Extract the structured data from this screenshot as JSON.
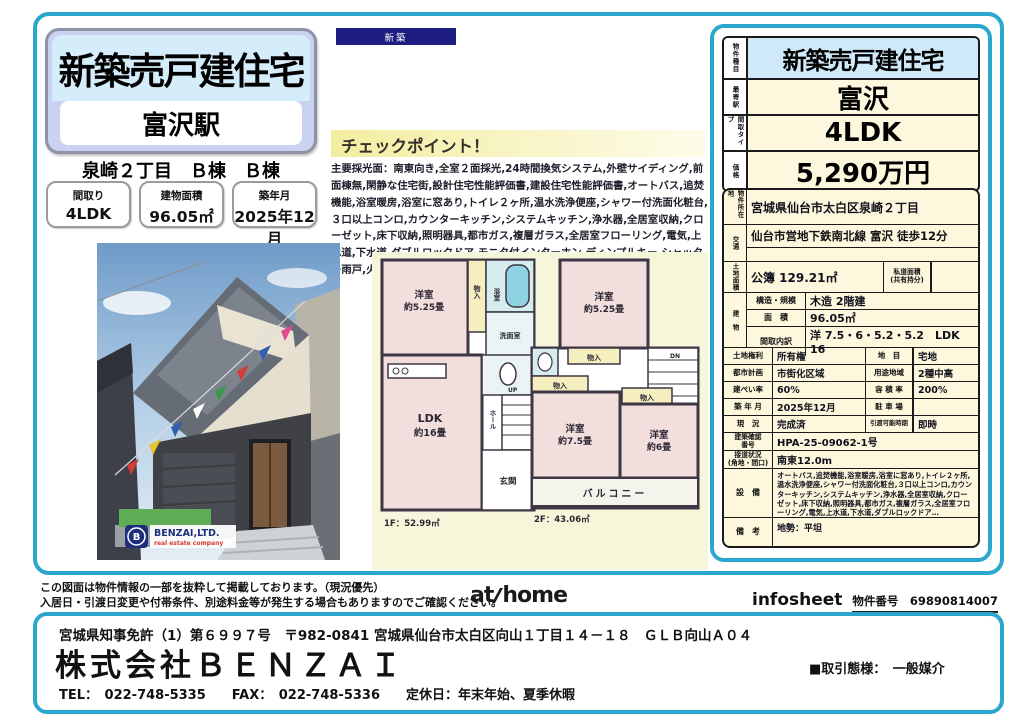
{
  "accent": {
    "cyan": "#2aa7cd",
    "navy": "#1d1d82",
    "cream": "#fdf8dd",
    "light_blue": "#cfe9f8"
  },
  "badge": {
    "label": "新築"
  },
  "title_card": {
    "title": "新築売戸建住宅",
    "station": "富沢駅",
    "location": "泉崎２丁目　Ｂ棟　Ｂ棟",
    "specs": [
      {
        "label": "間取り",
        "value": "4LDK"
      },
      {
        "label": "建物面積",
        "value": "96.05㎡"
      },
      {
        "label": "築年月",
        "value": "2025年12月"
      }
    ]
  },
  "checkpoint": {
    "heading": "チェックポイント！",
    "body": "主要採光面：南東向き,全室２面採光,24時間換気システム,外壁サイディング,前面棟無,閑静な住宅街,設計住宅性能評価書,建設住宅性能評価書,オートバス,追焚機能,浴室暖房,浴室に窓あり,トイレ２ヶ所,温水洗浄便座,シャワー付洗面化粧台,３口以上コンロ,カウンターキッチン,システムキッチン,浄水器,全居室収納,クローゼット,床下収納,照明器具,都市ガス,複層ガラス,全居室フローリング,電気,上水道,下水道,ダブルロックドア,モニタ付インターホン,ディンプルキー,シャッター雨戸,火災警報器（報知機）,ワイドバルコニー,駐車場２台分"
  },
  "photo": {
    "logo_initial": "B",
    "logo_name": "BENZAI,LTD.",
    "logo_sub": "real estate company"
  },
  "floorplan": {
    "f1": {
      "bedroom": "洋室",
      "bedroom_size": "約5.25畳",
      "closet": "物入",
      "bath": "浴室",
      "washroom": "洗面室",
      "ldk": "LDK",
      "ldk_size": "約16畳",
      "hall": "ホール",
      "up": "UP",
      "entrance": "玄関",
      "area": "1F：52.99㎡"
    },
    "f2": {
      "bedroom": "洋室",
      "bedroom_size": "約5.25畳",
      "closet1": "物入",
      "closet2": "物入",
      "closet3": "物入",
      "bedroom2": "洋室",
      "bedroom2_size": "約7.5畳",
      "bedroom3": "洋室",
      "bedroom3_size": "約6畳",
      "balcony": "バルコニー",
      "dn": "DN",
      "area": "2F：43.06㎡"
    }
  },
  "summary": {
    "rows": [
      {
        "label": "物件種目",
        "value": "新築売戸建住宅"
      },
      {
        "label": "最寄駅",
        "value": "富沢"
      },
      {
        "label": "間取タイプ",
        "value": "4LDK"
      },
      {
        "label": "価格",
        "value": "5,290万円"
      }
    ]
  },
  "detail": {
    "location_label": "物件所在地",
    "location": "宮城県仙台市太白区泉崎２丁目",
    "access_label": "交通",
    "access": "仙台市営地下鉄南北線 富沢 徒歩12分",
    "land_label": "土地面積",
    "land": "公簿 129.21㎡",
    "private_road_label1": "私道面積",
    "private_road_label2": "(共有持分)",
    "private_road": "",
    "building_label": "建　物",
    "structure_label": "構造・規模",
    "structure": "木造 2階建",
    "barea_label": "面　積",
    "barea": "96.05㎡",
    "layout_label": "間取内訳",
    "layout": "洋 7.5・6・5.2・5.2　LDK 16",
    "rows": [
      {
        "l1": "土地権利",
        "v1": "所有権",
        "l2": "地　目",
        "v2": "宅地"
      },
      {
        "l1": "都市計画",
        "v1": "市街化区域",
        "l2": "用途地域",
        "v2": "2種中高"
      },
      {
        "l1": "建ぺい率",
        "v1": "60%",
        "l2": "容 積 率",
        "v2": "200%"
      },
      {
        "l1": "築 年 月",
        "v1": "2025年12月",
        "l2": "駐 車 場",
        "v2": ""
      },
      {
        "l1": "現　況",
        "v1": "完成済",
        "l2": "引渡可能時期",
        "v2": "即時"
      }
    ],
    "confirm_label1": "建築確認",
    "confirm_label2": "番号",
    "confirm": "HPA-25-09062-1号",
    "road_label1": "接道状況",
    "road_label2": "(角地・間口)",
    "road": "南東12.0m",
    "equipment_label": "設　備",
    "equipment": "オートバス,追焚機能,浴室暖房,浴室に窓あり,トイレ２ヶ所,温水洗浄便座,シャワー付洗面化粧台,３口以上コンロ,カウンターキッチン,システムキッチン,浄水器,全居室収納,クローゼット,床下収納,照明器具,都市ガス,複層ガラス,全居室フローリング,電気,上水道,下水道,ダブルロックドア…",
    "remarks_label": "備　考",
    "remarks": "地勢：平坦"
  },
  "footer": {
    "disclaimer1": "この図面は物件情報の一部を抜粋して掲載しております。（現況優先）",
    "disclaimer2": "入居日・引渡日変更や付帯条件、別途料金等が発生する場合もありますのでご確認ください。",
    "athome_at": "at",
    "athome_home": "home",
    "infosheet": "infosheet",
    "property_no_label": "物件番号　69890814007"
  },
  "company": {
    "license": "宮城県知事免許（1）第６９９７号　〒982-0841 宮城県仙台市太白区向山１丁目１４－１８　ＧＬＢ向山Ａ０４",
    "name": "株式会社ＢＥＮＺＡＩ",
    "contact": "TEL：　022-748-5335　　FAX：　022-748-5336　　定休日：年末年始、夏季休暇",
    "transaction": "■取引態様：　一般媒介"
  }
}
